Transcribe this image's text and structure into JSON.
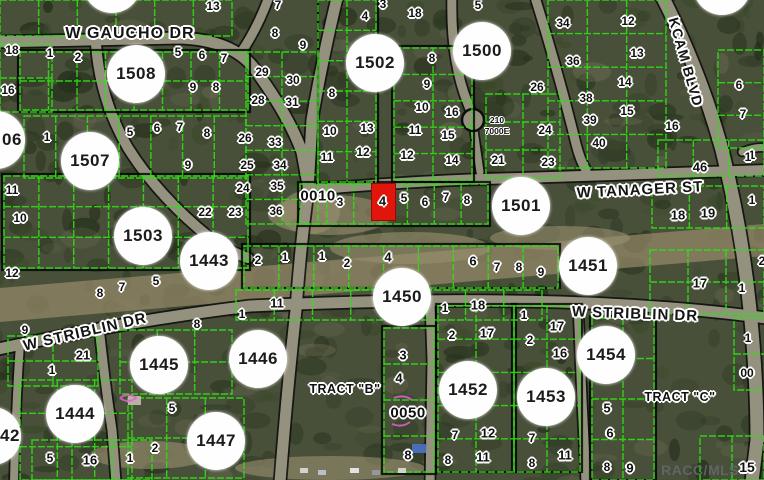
{
  "map": {
    "watermark": "RACC/MLS",
    "colors": {
      "terrain": "#49503a",
      "road": "#95917f",
      "road_casing": "#0d0d0d",
      "parcel_line": "#2ee012",
      "block_outline": "#000000",
      "clearing": "#95896a",
      "circle_fill": "#fefefe",
      "text": "#101010",
      "highlight": "#e0150c",
      "watermark_color": "#63686d"
    },
    "streets": [
      {
        "name": "W GAUCHO DR",
        "x": 130,
        "y": 34,
        "rotate": 0,
        "size": 16
      },
      {
        "name": "W TANAGER ST",
        "x": 640,
        "y": 190,
        "rotate": -3,
        "size": 15
      },
      {
        "name": "KCAM BLVD",
        "x": 686,
        "y": 62,
        "rotate": 74,
        "size": 14
      },
      {
        "name": "W STRIBLIN DR",
        "x": 85,
        "y": 332,
        "rotate": -13,
        "size": 15
      },
      {
        "name": "W STRIBLIN DR",
        "x": 635,
        "y": 314,
        "rotate": 2,
        "size": 15
      }
    ],
    "sections": [
      {
        "label": "06",
        "x": -4,
        "y": 140,
        "dx": 16
      },
      {
        "label": "1508",
        "x": 136,
        "y": 74
      },
      {
        "label": "1507",
        "x": 90,
        "y": 161
      },
      {
        "label": "1503",
        "x": 143,
        "y": 236
      },
      {
        "label": "1443",
        "x": 209,
        "y": 261
      },
      {
        "label": "1502",
        "x": 375,
        "y": 63
      },
      {
        "label": "1500",
        "x": 482,
        "y": 51
      },
      {
        "label": "1501",
        "x": 521,
        "y": 206
      },
      {
        "label": "1451",
        "x": 588,
        "y": 266
      },
      {
        "label": "1450",
        "x": 402,
        "y": 297
      },
      {
        "label": "1446",
        "x": 258,
        "y": 359
      },
      {
        "label": "1445",
        "x": 159,
        "y": 365
      },
      {
        "label": "1444",
        "x": 75,
        "y": 414
      },
      {
        "label": "42",
        "x": -8,
        "y": 436,
        "dx": 18
      },
      {
        "label": "1447",
        "x": 216,
        "y": 441
      },
      {
        "label": "1452",
        "x": 468,
        "y": 390
      },
      {
        "label": "1453",
        "x": 546,
        "y": 397
      },
      {
        "label": "1454",
        "x": 606,
        "y": 355
      },
      {
        "label": "",
        "x": 112,
        "y": -16
      },
      {
        "label": "",
        "x": 722,
        "y": -14
      }
    ],
    "lots": [
      [
        213,
        6,
        "13"
      ],
      [
        12,
        50,
        "18"
      ],
      [
        8,
        90,
        "16"
      ],
      [
        50,
        53,
        "1"
      ],
      [
        78,
        57,
        "2"
      ],
      [
        178,
        52,
        "5"
      ],
      [
        202,
        55,
        "6"
      ],
      [
        224,
        58,
        "7"
      ],
      [
        193,
        87,
        "9"
      ],
      [
        216,
        87,
        "8"
      ],
      [
        47,
        137,
        "1"
      ],
      [
        130,
        132,
        "5"
      ],
      [
        157,
        128,
        "6"
      ],
      [
        180,
        127,
        "7"
      ],
      [
        207,
        133,
        "8"
      ],
      [
        188,
        165,
        "9"
      ],
      [
        12,
        190,
        "11"
      ],
      [
        20,
        218,
        "10"
      ],
      [
        12,
        273,
        "12"
      ],
      [
        100,
        293,
        "8"
      ],
      [
        122,
        287,
        "7"
      ],
      [
        156,
        281,
        "5"
      ],
      [
        262,
        72,
        "29"
      ],
      [
        293,
        80,
        "30"
      ],
      [
        258,
        100,
        "28"
      ],
      [
        292,
        102,
        "31"
      ],
      [
        245,
        138,
        "26"
      ],
      [
        275,
        142,
        "33"
      ],
      [
        247,
        165,
        "25"
      ],
      [
        280,
        165,
        "34"
      ],
      [
        243,
        188,
        "24"
      ],
      [
        277,
        186,
        "35"
      ],
      [
        205,
        212,
        "22"
      ],
      [
        235,
        212,
        "23"
      ],
      [
        276,
        211,
        "36"
      ],
      [
        278,
        5,
        "7"
      ],
      [
        275,
        33,
        "8"
      ],
      [
        303,
        45,
        "9"
      ],
      [
        332,
        93,
        "8"
      ],
      [
        330,
        131,
        "10"
      ],
      [
        367,
        128,
        "13"
      ],
      [
        327,
        157,
        "11"
      ],
      [
        363,
        152,
        "12"
      ],
      [
        383,
        4,
        "3"
      ],
      [
        365,
        16,
        "4"
      ],
      [
        415,
        13,
        "18"
      ],
      [
        478,
        5,
        "5"
      ],
      [
        432,
        58,
        "8"
      ],
      [
        427,
        84,
        "9"
      ],
      [
        422,
        107,
        "10"
      ],
      [
        452,
        112,
        "16"
      ],
      [
        415,
        130,
        "11"
      ],
      [
        448,
        135,
        "15"
      ],
      [
        407,
        155,
        "12"
      ],
      [
        452,
        160,
        "14"
      ],
      [
        545,
        130,
        "24"
      ],
      [
        498,
        160,
        "21"
      ],
      [
        548,
        162,
        "23"
      ],
      [
        563,
        23,
        "34"
      ],
      [
        573,
        61,
        "36"
      ],
      [
        537,
        87,
        "26"
      ],
      [
        586,
        98,
        "38"
      ],
      [
        590,
        120,
        "39"
      ],
      [
        599,
        143,
        "40"
      ],
      [
        628,
        21,
        "12"
      ],
      [
        637,
        53,
        "13"
      ],
      [
        625,
        82,
        "14"
      ],
      [
        627,
        111,
        "15"
      ],
      [
        672,
        126,
        "16"
      ],
      [
        739,
        85,
        "6"
      ],
      [
        743,
        114,
        "7"
      ],
      [
        752,
        155,
        "1"
      ],
      [
        700,
        167,
        "46",
        13
      ],
      [
        748,
        157,
        "1"
      ],
      [
        340,
        202,
        "3"
      ],
      [
        404,
        198,
        "5"
      ],
      [
        425,
        202,
        "6"
      ],
      [
        446,
        197,
        "7"
      ],
      [
        467,
        200,
        "8"
      ],
      [
        678,
        215,
        "18",
        13
      ],
      [
        708,
        213,
        "19",
        13
      ],
      [
        752,
        200,
        "1"
      ],
      [
        258,
        260,
        "2"
      ],
      [
        285,
        257,
        "1"
      ],
      [
        322,
        256,
        "1"
      ],
      [
        347,
        263,
        "2"
      ],
      [
        388,
        257,
        "4",
        13
      ],
      [
        473,
        261,
        "6",
        13
      ],
      [
        497,
        267,
        "7"
      ],
      [
        519,
        267,
        "8"
      ],
      [
        541,
        272,
        "9"
      ],
      [
        700,
        283,
        "17",
        13
      ],
      [
        742,
        288,
        "1"
      ],
      [
        762,
        261,
        "2"
      ],
      [
        277,
        303,
        "11",
        13
      ],
      [
        242,
        314,
        "1"
      ],
      [
        445,
        308,
        "1"
      ],
      [
        478,
        305,
        "18",
        13
      ],
      [
        25,
        330,
        "9"
      ],
      [
        83,
        355,
        "21",
        13
      ],
      [
        52,
        370,
        "1"
      ],
      [
        197,
        324,
        "8"
      ],
      [
        172,
        408,
        "5"
      ],
      [
        50,
        458,
        "5"
      ],
      [
        90,
        460,
        "16",
        13
      ],
      [
        130,
        458,
        "1"
      ],
      [
        155,
        448,
        "2"
      ],
      [
        403,
        355,
        "3",
        13
      ],
      [
        399,
        378,
        "4",
        13
      ],
      [
        408,
        455,
        "8",
        13
      ],
      [
        452,
        335,
        "2"
      ],
      [
        487,
        333,
        "17",
        13
      ],
      [
        455,
        435,
        "7"
      ],
      [
        488,
        433,
        "12",
        13
      ],
      [
        448,
        460,
        "8"
      ],
      [
        483,
        457,
        "11",
        13
      ],
      [
        524,
        315,
        "1"
      ],
      [
        530,
        340,
        "2"
      ],
      [
        557,
        326,
        "17",
        13
      ],
      [
        560,
        353,
        "16",
        13
      ],
      [
        532,
        438,
        "7"
      ],
      [
        565,
        455,
        "11",
        13
      ],
      [
        532,
        463,
        "8"
      ],
      [
        607,
        408,
        "5",
        13
      ],
      [
        610,
        433,
        "6",
        13
      ],
      [
        607,
        467,
        "8"
      ],
      [
        630,
        468,
        "9",
        13
      ],
      [
        747,
        467,
        "15",
        14
      ],
      [
        748,
        338,
        "1"
      ],
      [
        747,
        373,
        "00"
      ]
    ],
    "labels": [
      {
        "text": "0010",
        "x": 318,
        "y": 196,
        "cls": "plat-label"
      },
      {
        "text": "0050",
        "x": 408,
        "y": 413,
        "cls": "plat-label"
      },
      {
        "text": "210",
        "x": 497,
        "y": 120,
        "cls": "tiny-label"
      },
      {
        "text": "7000E",
        "x": 497,
        "y": 131,
        "cls": "tiny-label"
      },
      {
        "text": "TRACT \"B\"",
        "x": 345,
        "y": 389,
        "cls": "tract-label"
      },
      {
        "text": "TRACT \"C\"",
        "x": 680,
        "y": 397,
        "cls": "tract-label"
      }
    ],
    "highlight": {
      "x": 371,
      "y": 183,
      "w": 23,
      "h": 36,
      "lot": "4"
    }
  }
}
